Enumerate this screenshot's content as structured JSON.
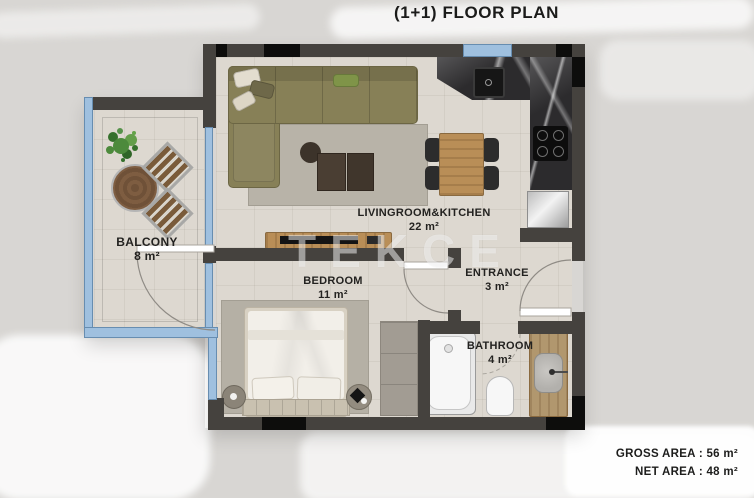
{
  "header": {
    "title": "(1+1) FLOOR PLAN"
  },
  "rooms": [
    {
      "name": "LIVINGROOM&KITCHEN",
      "area": "22 m²"
    },
    {
      "name": "BEDROOM",
      "area": "11 m²"
    },
    {
      "name": "BALCONY",
      "area": "8 m²"
    },
    {
      "name": "ENTRANCE",
      "area": "3 m²"
    },
    {
      "name": "BATHROOM",
      "area": "4 m²"
    }
  ],
  "footer": {
    "lines": [
      "GROSS AREA : 56 m²",
      "NET AREA : 48 m²"
    ]
  },
  "watermark": "TEKCE",
  "colors": {
    "wall": "#45423e",
    "wall_black": "#0d0d0c",
    "glass_window": "#9fc0df",
    "floor_tile": "#ddd8d0",
    "marble_counter": "#2c2b2d",
    "wood": "#b98e57",
    "sofa_olive": "#878057",
    "background": "#d8d6d3"
  }
}
